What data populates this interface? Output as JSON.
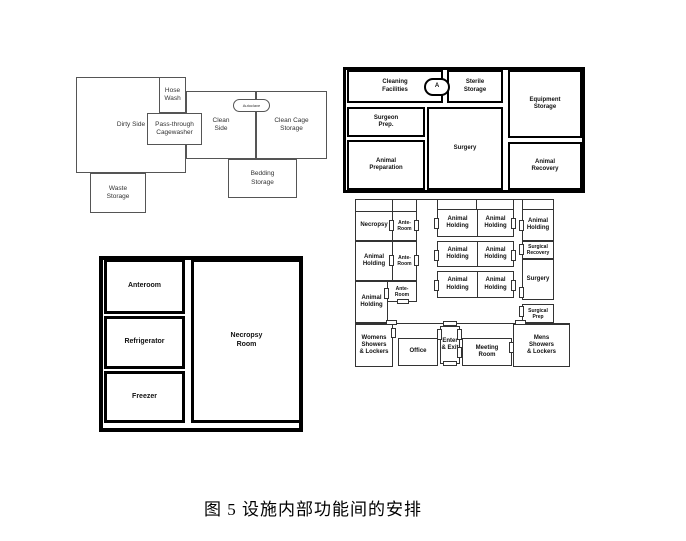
{
  "caption": "图 5 设施内部功能间的安排",
  "cage_wash": {
    "dirty_side": "Dirty Side",
    "hose_wash": "Hose Wash",
    "pass_through_cagewasher": "Pass-through Cagewasher",
    "clean_side": "Clean Side",
    "clean_cage_storage": "Clean Cage Storage",
    "autoclave": "Autoclave",
    "bedding_storage": "Bedding Storage",
    "waste_storage": "Waste Storage"
  },
  "surgery_suite": {
    "cleaning_facilities": "Cleaning Facilities",
    "autoclave_abbrev": "A",
    "sterile_storage": "Sterile Storage",
    "equipment_storage": "Equipment Storage",
    "surgeon_prep": "Surgeon Prep.",
    "surgery": "Surgery",
    "animal_preparation": "Animal Preparation",
    "animal_recovery": "Animal Recovery"
  },
  "necropsy_suite": {
    "anteroom": "Anteroom",
    "refrigerator": "Refrigerator",
    "freezer": "Freezer",
    "necropsy_room": "Necropsy Room"
  },
  "holding_plan": {
    "necropsy": "Necropsy",
    "ante_room": "Ante-Room",
    "animal_holding": "Animal Holding",
    "surgical_recovery": "Surgical Recovery",
    "surgery": "Surgery",
    "surgical_prep": "Surgical Prep",
    "womens_showers_lockers": "Womens Showers & Lockers",
    "office": "Office",
    "enter_exit": "Enter & Exit",
    "meeting_room": "Meeting Room",
    "mens_showers_lockers": "Mens Showers & Lockers"
  },
  "colors": {
    "line_thin": "#555555",
    "line_thick": "#000000",
    "text": "#1a1a1a"
  }
}
